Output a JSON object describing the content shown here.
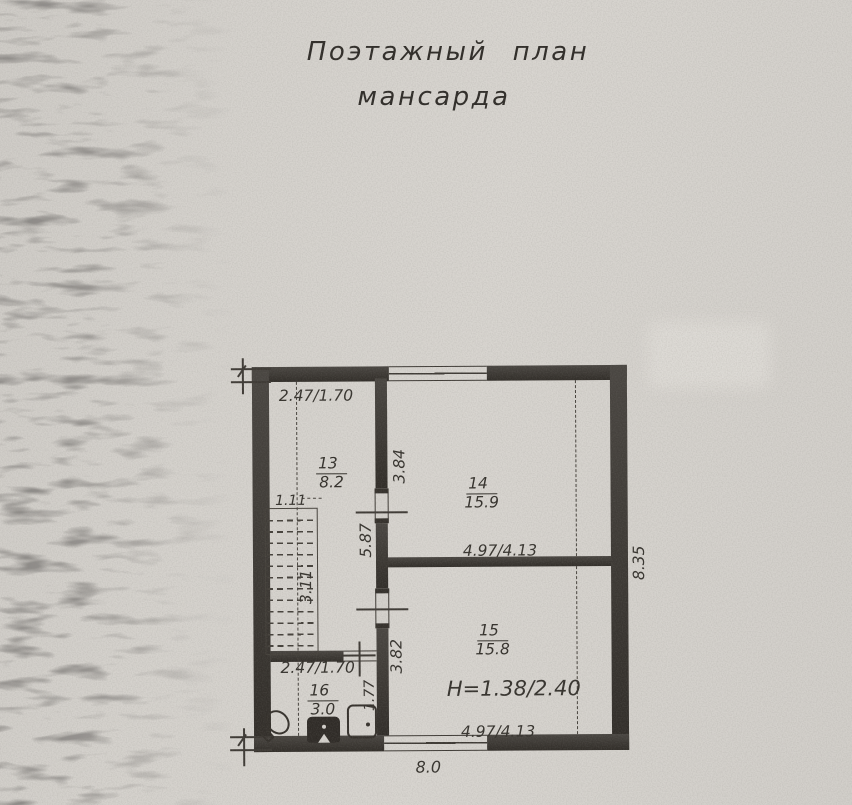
{
  "document": {
    "title_line1": "Поэтажный план",
    "title_line2": "мансарда"
  },
  "rooms": [
    {
      "number": "13",
      "area": "8.2"
    },
    {
      "number": "14",
      "area": "15.9"
    },
    {
      "number": "15",
      "area": "15.8"
    },
    {
      "number": "16",
      "area": "3.0"
    }
  ],
  "dimensions": {
    "room13_width": "2.47/1.70",
    "room14_left": "3.84",
    "room14_width": "4.97/4.13",
    "hall_height": "5.87",
    "stairs_width": "1.11",
    "stairs_length": "3.11",
    "room15_left": "3.82",
    "room15_width": "4.97/4.13",
    "room16_width": "2.47/1.70",
    "room16_right": "1.77",
    "total_height_right": "8.35",
    "total_width_bottom": "8.0",
    "ceiling_height": "H=1.38/2.40"
  },
  "colors": {
    "paper": "#d5d2cd",
    "wall": "#35312c",
    "ink": "#3a3631"
  }
}
